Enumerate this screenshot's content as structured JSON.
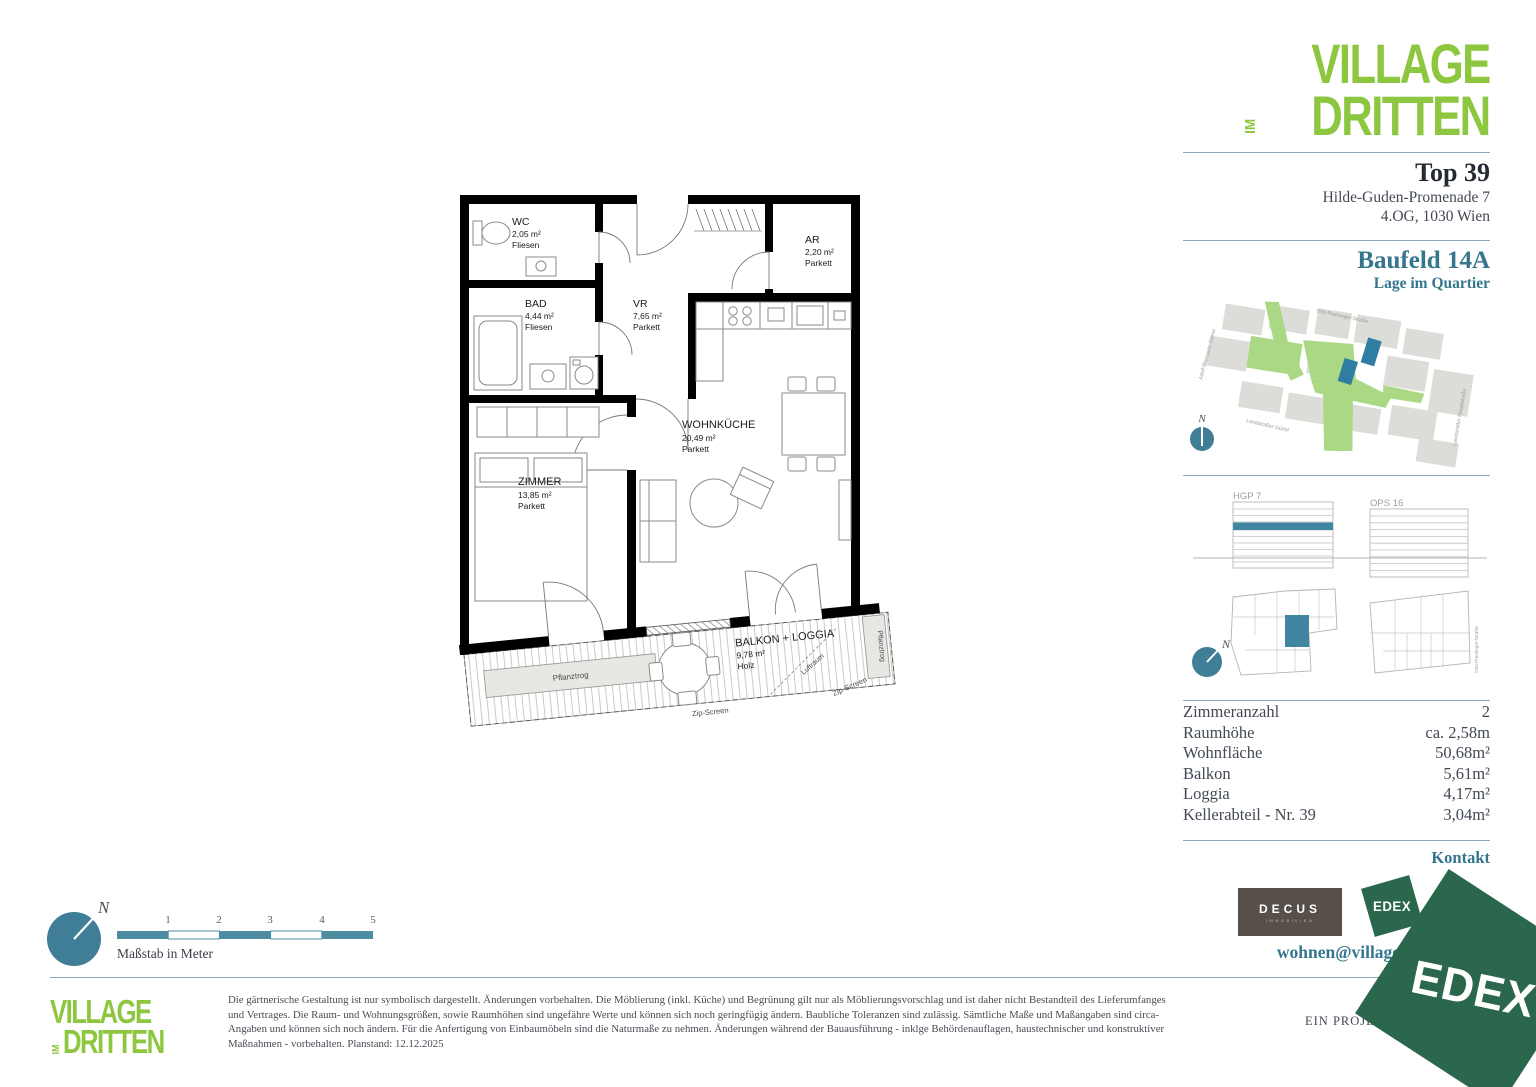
{
  "brand": {
    "line1": "VILLAGE",
    "im": "IM",
    "line2": "DRITTEN",
    "green": "#8dc63f",
    "teal": "#35768e",
    "dark_text": "#3a4049"
  },
  "header": {
    "unit_title": "Top 39",
    "address_line1": "Hilde-Guden-Promenade 7",
    "address_line2": "4.OG, 1030 Wien"
  },
  "quartier": {
    "title": "Baufeld 14A",
    "subtitle": "Lage im Quartier",
    "compass_n": "N",
    "streets": [
      "Otto-Preminger-Straße",
      "Adolf-Blamauer-Gasse",
      "Landstraßer Gürtel",
      "Landstraßer Hauptstraße"
    ],
    "highlight_color": "#2f7da0",
    "green_color": "#abd884",
    "building_gray": "#dcdcd8"
  },
  "sections": {
    "left_label": "HGP 7",
    "right_label": "OPS 16",
    "street_label": "Otto-Preminger-Straße",
    "compass_n": "N",
    "floor_highlight": "#4186a0"
  },
  "details": {
    "rows": [
      {
        "label": "Zimmeranzahl",
        "value": "2"
      },
      {
        "label": "Raumhöhe",
        "value": "ca. 2,58m"
      },
      {
        "label": "Wohnfläche",
        "value": "50,68m²"
      },
      {
        "label": "Balkon",
        "value": "5,61m²"
      },
      {
        "label": "Loggia",
        "value": "4,17m²"
      },
      {
        "label": "Kellerabteil - Nr. 39",
        "value": "3,04m²"
      }
    ]
  },
  "contact": {
    "title": "Kontakt",
    "email": "wohnen@villageimdritten.at",
    "decus": "DECUS",
    "decus_sub": "IMMOBILIEN",
    "edex": "EDEX",
    "ehl": "EHL"
  },
  "footer": {
    "project_label": "EIN PROJEKT VON",
    "watermark": "EDEX",
    "disclaimer": "Die gärtnerische Gestaltung ist nur symbolisch dargestellt. Änderungen vorbehalten. Die Möblierung (inkl. Küche) und Begrünung gilt nur als Möblierungsvorschlag und ist daher nicht Bestandteil des Lieferumfanges und Vertrages. Die Raum- und Wohnungsgrößen, sowie Raumhöhen sind ungefähre Werte und können sich noch geringfügig ändern. Baubliche Toleranzen sind zulässig. Sämtliche Maße und Maßangaben sind circa-Angaben und können sich noch ändern. Für die Anfertigung von Einbaumöbeln sind die Naturmaße zu nehmen. Änderungen während der Bauausführung - inklge Behördenauflagen, haustechnischer und konstruktiver Maßnahmen - vorbehalten. Planstand: 12.12.2025"
  },
  "scalebar": {
    "labels": [
      "1",
      "2",
      "3",
      "4",
      "5"
    ],
    "caption": "Maßstab in Meter",
    "compass_n": "N"
  },
  "floorplan": {
    "rooms": [
      {
        "name": "WC",
        "area": "2,05 m²",
        "floor": "Fliesen"
      },
      {
        "name": "BAD",
        "area": "4,44 m²",
        "floor": "Fliesen"
      },
      {
        "name": "VR",
        "area": "7,65 m²",
        "floor": "Parkett"
      },
      {
        "name": "AR",
        "area": "2,20 m²",
        "floor": "Parkett"
      },
      {
        "name": "WOHNKÜCHE",
        "area": "20,49 m²",
        "floor": "Parkett"
      },
      {
        "name": "ZIMMER",
        "area": "13,85 m²",
        "floor": "Parkett"
      },
      {
        "name": "BALKON + LOGGIA",
        "area": "9,78 m²",
        "floor": "Holz"
      }
    ],
    "annotations": {
      "planter": "Pflanztrog",
      "zip": "Zip-Screen",
      "airspace": "Luftraum"
    }
  }
}
